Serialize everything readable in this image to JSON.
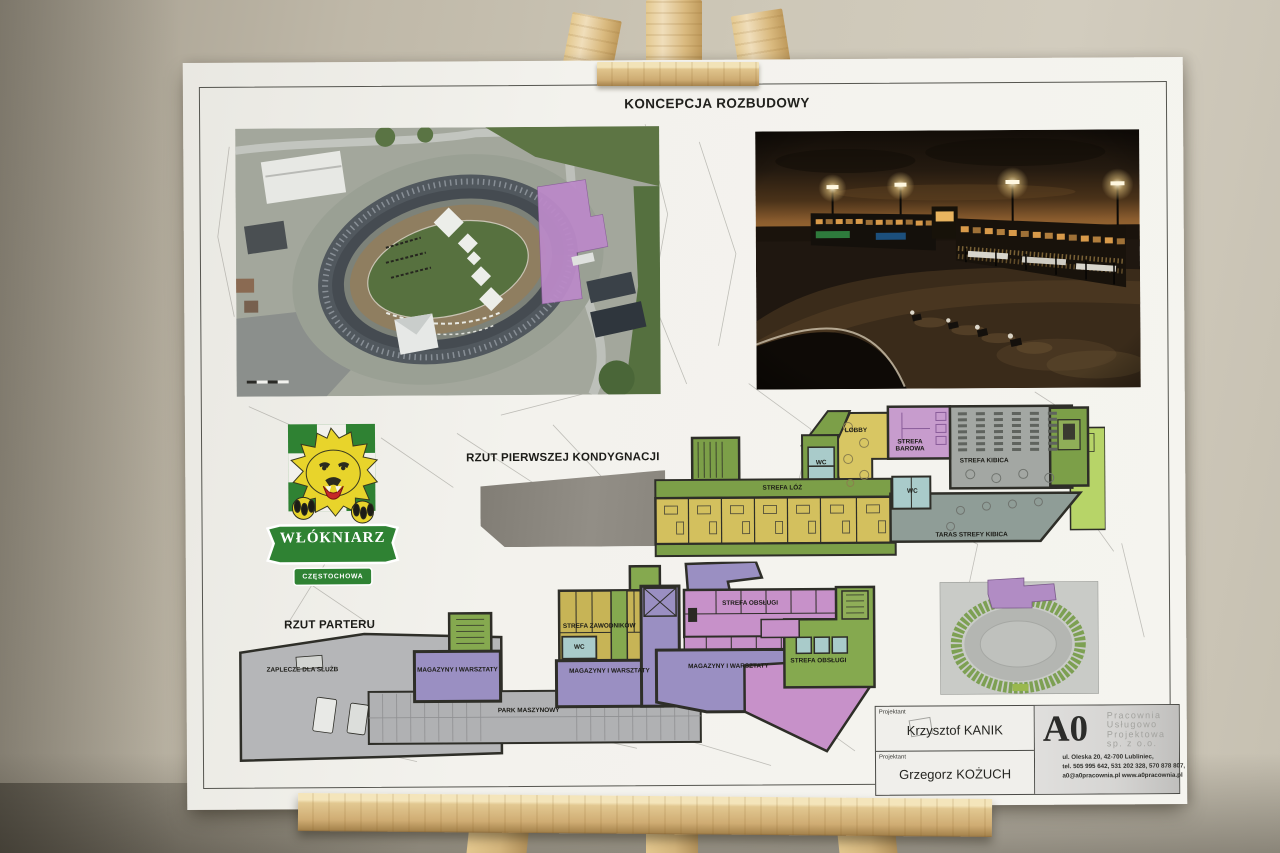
{
  "board": {
    "title": "KONCEPCJA ROZBUDOWY",
    "logo": {
      "club": "WŁÓKNIARZ",
      "city": "CZĘSTOCHOWA"
    },
    "first_floor": {
      "heading": "RZUT PIERWSZEJ KONDYGNACJI",
      "lobby": "LOBBY",
      "bar": "STREFA BAROWA",
      "fans": "STREFA KIBICA",
      "wc": "WC",
      "boxes": "STREFA LÓŻ",
      "terrace": "TARAS STREFY KIBICA"
    },
    "ground_floor": {
      "heading": "RZUT PARTERU",
      "services_backroom": "ZAPLECZE DLA SŁUŻB",
      "workshops": "MAGAZYNY I WARSZTATY",
      "machine_park": "PARK MASZYNOWY",
      "riders": "STREFA ZAWODNIKÓW",
      "wc": "WC",
      "service_area": "STREFA OBSŁUGI"
    },
    "title_block": {
      "role": "Projektant",
      "designer1": "Krzysztof KANIK",
      "designer2": "Grzegorz KOŻUCH",
      "company_short": "A0",
      "company_line1": "Pracownia",
      "company_line2": "Usługowo",
      "company_line3": "Projektowa",
      "company_line4": "sp. z o.o.",
      "address": "ul. Oleska 20, 42-700 Lubliniec,",
      "phones": "tel. 505 995 642, 531 202 328, 570 878 807,",
      "contact": "a0@a0pracownia.pl www.a0pracownia.pl"
    },
    "colors": {
      "green_zone": "#7c9f48",
      "yellow_zone": "#d3c05e",
      "purple_zone": "#c79ccd",
      "violet_zone": "#9a8fc2",
      "pink_zone": "#c791c9",
      "gray_zone": "#a3a7a3",
      "wc_blue": "#a9cbca",
      "extension_purple": "#bb8ac8"
    }
  }
}
